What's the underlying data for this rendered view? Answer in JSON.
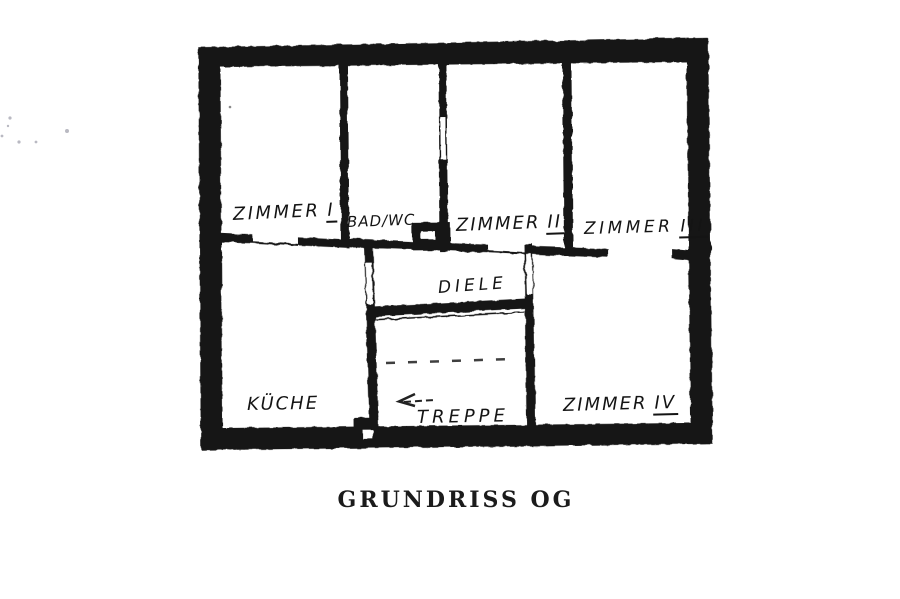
{
  "page": {
    "background_color": "#ffffff",
    "ink_color": "#181818",
    "type_note": "hand-drawn photocopied floor plan"
  },
  "caption": {
    "text": "GRUNDRISS OG"
  },
  "rooms": [
    {
      "key": "zimmer-1",
      "name": "ZIMMER",
      "numeral": "I"
    },
    {
      "key": "bad-wc",
      "name": "BAD/WC",
      "numeral": ""
    },
    {
      "key": "zimmer-2",
      "name": "ZIMMER",
      "numeral": "II"
    },
    {
      "key": "zimmer-3",
      "name": "ZIMMER",
      "numeral": "III"
    },
    {
      "key": "diele",
      "name": "DIELE",
      "numeral": ""
    },
    {
      "key": "kueche",
      "name": "KÜCHE",
      "numeral": ""
    },
    {
      "key": "treppe",
      "name": "TREPPE",
      "numeral": ""
    },
    {
      "key": "zimmer-4",
      "name": "ZIMMER",
      "numeral": "IV"
    }
  ],
  "symbols": {
    "stairs_arrow": "left-direction-arrow",
    "stairs_dashed_line": "stair-midline",
    "door_gaps": [
      "zimmer1-door",
      "bad-zimmer2-door",
      "zimmer2-door",
      "kueche-diele-door",
      "diele-zimmer4-door",
      "zimmer3-opening",
      "treppe-bottom-door",
      "chimney-opening"
    ]
  }
}
